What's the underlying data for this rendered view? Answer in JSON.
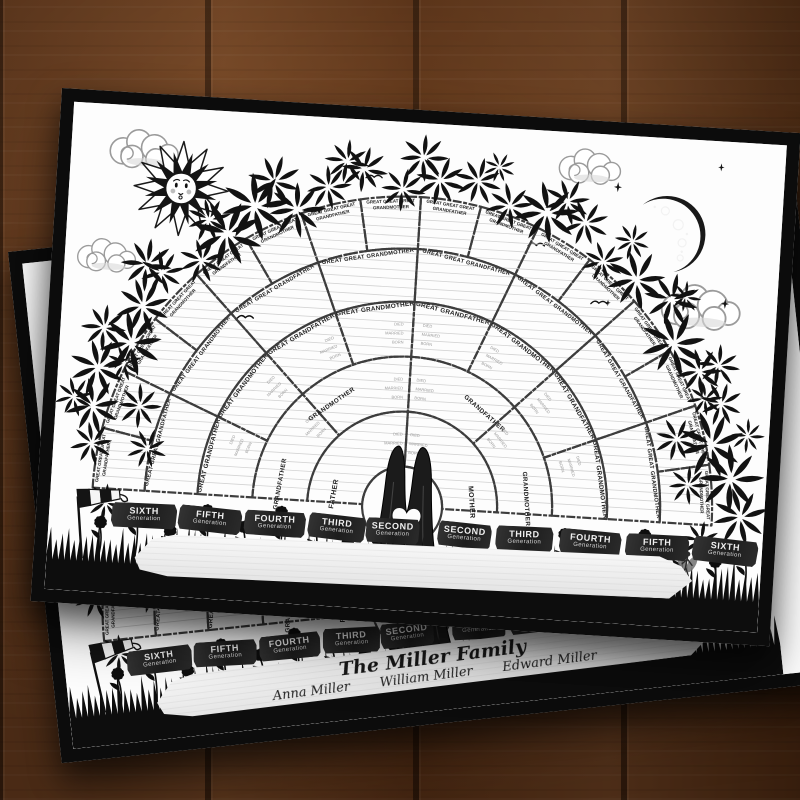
{
  "scene": {
    "surface": "wood-plank-table",
    "wood_color": "#6a3d1f",
    "poster_border_color": "#0c0c0c",
    "decorations": [
      "sun-face-icon",
      "crescent-moon-icon",
      "cloud-icon",
      "bird-icon",
      "star-sparkle-icon",
      "foliage-arch",
      "tree-trunk-heart",
      "grass-silhouette",
      "flower-icon",
      "windsock-icon",
      "fairy-icon",
      "wooden-sign"
    ]
  },
  "front_poster": {
    "sign_text": "",
    "fan_chart": {
      "type": "genealogy-fan",
      "cell_fields": [
        "BORN",
        "MARRIED",
        "DIED"
      ],
      "rings": [
        {
          "generation": 2,
          "cells": [
            "FATHER",
            "MOTHER"
          ]
        },
        {
          "generation": 3,
          "cells": [
            "GRANDFATHER",
            "GRANDMOTHER",
            "GRANDFATHER",
            "GRANDMOTHER"
          ]
        },
        {
          "generation": 4,
          "cells": [
            "GREAT GRANDFATHER",
            "GREAT GRANDMOTHER",
            "GREAT GRANDFATHER",
            "GREAT GRANDMOTHER",
            "GREAT GRANDFATHER",
            "GREAT GRANDMOTHER",
            "GREAT GRANDFATHER",
            "GREAT GRANDMOTHER"
          ]
        },
        {
          "generation": 5,
          "cells": [
            "GREAT GREAT GRANDFATHER",
            "GREAT GREAT GRANDMOTHER",
            "GREAT GREAT GRANDFATHER",
            "GREAT GREAT GRANDMOTHER",
            "GREAT GREAT GRANDFATHER",
            "GREAT GREAT GRANDMOTHER",
            "GREAT GREAT GRANDFATHER",
            "GREAT GREAT GRANDMOTHER"
          ]
        },
        {
          "generation": 6,
          "cells": [
            "GREAT GREAT GREAT GRANDFATHER",
            "GREAT GREAT GREAT GRANDMOTHER",
            "GREAT GREAT GREAT GRANDFATHER",
            "GREAT GREAT GREAT GRANDMOTHER",
            "GREAT GREAT GREAT GRANDFATHER",
            "GREAT GREAT GREAT GRANDMOTHER",
            "GREAT GREAT GREAT GRANDFATHER",
            "GREAT GREAT GREAT GRANDMOTHER",
            "GREAT GREAT GREAT GRANDFATHER",
            "GREAT GREAT GREAT GRANDMOTHER",
            "GREAT GREAT GREAT GRANDFATHER",
            "GREAT GREAT GREAT GRANDMOTHER",
            "GREAT GREAT GREAT GRANDFATHER",
            "GREAT GREAT GREAT GRANDMOTHER",
            "GREAT GREAT GREAT GRANDFATHER",
            "GREAT GREAT GREAT GRANDMOTHER"
          ]
        }
      ]
    },
    "generation_tickets_left": [
      {
        "title": "SIXTH",
        "subtitle": "Generation"
      },
      {
        "title": "FIFTH",
        "subtitle": "Generation"
      },
      {
        "title": "FOURTH",
        "subtitle": "Generation"
      },
      {
        "title": "THIRD",
        "subtitle": "Generation"
      },
      {
        "title": "SECOND",
        "subtitle": "Generation"
      }
    ],
    "generation_tickets_right": [
      {
        "title": "SECOND",
        "subtitle": "Generation"
      },
      {
        "title": "THIRD",
        "subtitle": "Generation"
      },
      {
        "title": "FOURTH",
        "subtitle": "Generation"
      },
      {
        "title": "FIFTH",
        "subtitle": "Generation"
      },
      {
        "title": "SIXTH",
        "subtitle": "Generation"
      }
    ]
  },
  "back_poster": {
    "sign": {
      "title": "The Miller Family",
      "names": [
        "Anna Miller",
        "William Miller",
        "Edward Miller"
      ]
    },
    "handwritten_entries": [
      "Bryan Miller",
      "Oct 17th 1869",
      "July 12th 1890",
      "April 3rd 1900",
      "June Miller",
      "August 6th 1893",
      "Juanita Miller",
      "July 20th 1915"
    ]
  }
}
